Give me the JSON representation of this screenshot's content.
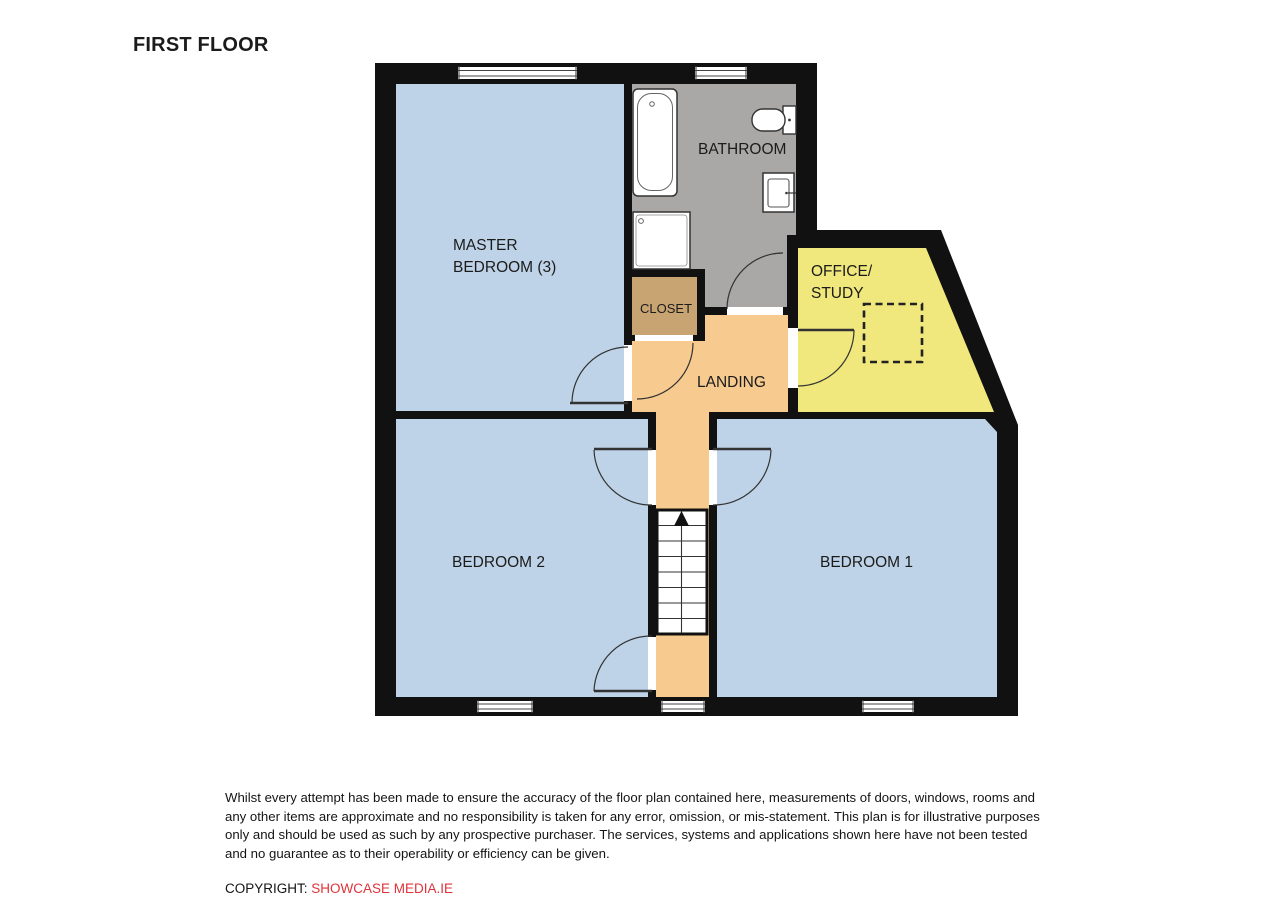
{
  "title": "FIRST FLOOR",
  "rooms": {
    "master_bedroom": {
      "line1": "MASTER",
      "line2": "BEDROOM (3)"
    },
    "bathroom": {
      "label": "BATHROOM"
    },
    "closet": {
      "label": "CLOSET"
    },
    "office_study": {
      "line1": "OFFICE/",
      "line2": "STUDY"
    },
    "landing": {
      "label": "LANDING"
    },
    "bedroom2": {
      "label": "BEDROOM 2"
    },
    "bedroom1": {
      "label": "BEDROOM 1"
    }
  },
  "colors": {
    "wall": "#111111",
    "bedroom_fill": "#bed3e7",
    "bathroom_fill": "#a9a8a6",
    "closet_fill": "#c9a473",
    "landing_fill": "#f7ca90",
    "office_fill": "#f1e87d",
    "copyright_red": "#e0333a",
    "label_text": "#1b1b1b"
  },
  "footer": {
    "disclaimer": "Whilst every attempt has been made to ensure the accuracy of the floor plan contained here, measurements of doors, windows, rooms and any other items are approximate and no responsibility is taken for any error, omission, or mis-statement.  This plan is for illustrative purposes only and should be used as such by any prospective purchaser.  The services, systems and applications shown here have not been tested and no guarantee as to their operability or efficiency can be given.",
    "copyright_label": "COPYRIGHT:",
    "copyright_company": "SHOWCASE MEDIA.IE"
  }
}
